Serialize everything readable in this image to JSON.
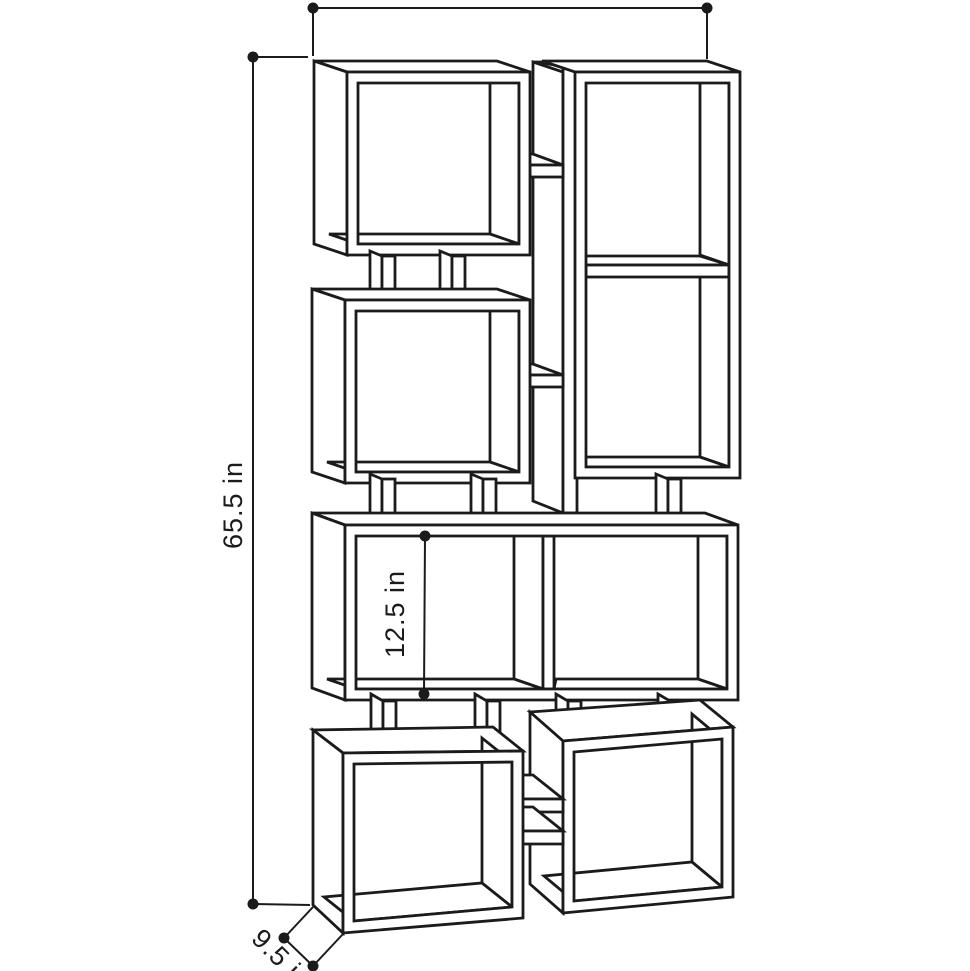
{
  "dimensions": {
    "height": "65.5 in",
    "compartment_height": "12.5 in",
    "depth": "9.5 in"
  },
  "colors": {
    "line": "#1b1b1b",
    "bg": "#ffffff"
  }
}
